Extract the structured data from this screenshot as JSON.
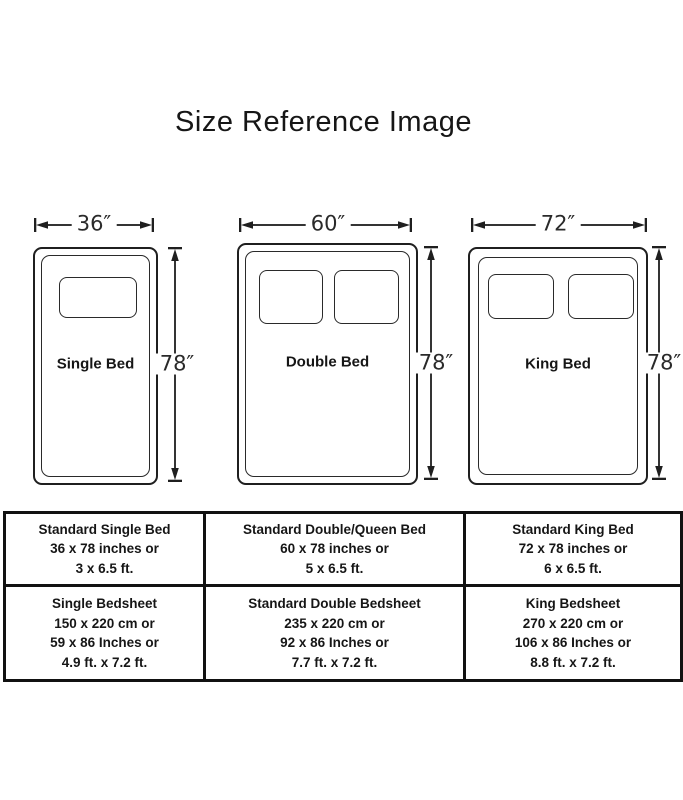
{
  "title": "Size Reference Image",
  "beds": [
    {
      "name": "Single Bed",
      "width_label": "36″",
      "height_label": "78″",
      "pillow_count": 1
    },
    {
      "name": "Double Bed",
      "width_label": "60″",
      "height_label": "78″",
      "pillow_count": 2
    },
    {
      "name": "King Bed",
      "width_label": "72″",
      "height_label": "78″",
      "pillow_count": 2
    }
  ],
  "table": {
    "rows": [
      {
        "cells": [
          {
            "lines": [
              "Standard Single Bed",
              "36 x 78 inches or",
              "3 x 6.5 ft."
            ]
          },
          {
            "lines": [
              "Standard Double/Queen Bed",
              "60 x 78 inches or",
              "5 x 6.5 ft."
            ]
          },
          {
            "lines": [
              "Standard King Bed",
              "72 x 78 inches or",
              "6 x 6.5 ft."
            ]
          }
        ]
      },
      {
        "cells": [
          {
            "lines": [
              "Single Bedsheet",
              "150 x 220 cm or",
              "59 x 86 Inches or",
              "4.9 ft. x 7.2 ft."
            ]
          },
          {
            "lines": [
              "Standard Double Bedsheet",
              "235 x 220 cm or",
              "92 x 86 Inches or",
              "7.7 ft. x 7.2 ft."
            ]
          },
          {
            "lines": [
              "King Bedsheet",
              "270 x 220 cm or",
              "106 x 86 Inches or",
              "8.8 ft. x 7.2 ft."
            ]
          }
        ]
      }
    ]
  },
  "colors": {
    "ink": "#1f1f1f",
    "background": "#ffffff"
  }
}
